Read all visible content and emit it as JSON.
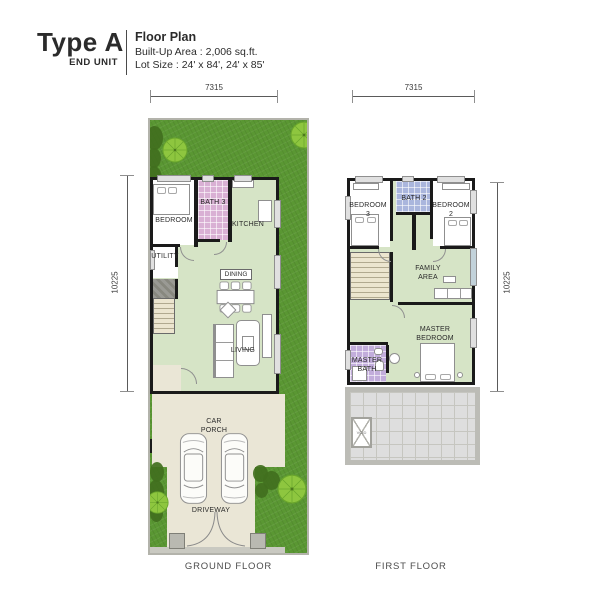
{
  "header": {
    "type": "Type A",
    "unit": "END UNIT",
    "title": "Floor Plan",
    "built_up": "Built-Up Area : 2,006 sq.ft.",
    "lot_size": "Lot Size : 24' x 84', 24' x 85'"
  },
  "ground_floor": {
    "caption": "GROUND FLOOR",
    "dims": {
      "width": "7315",
      "depth": "10225"
    },
    "labels": {
      "bedroom": "BEDROOM",
      "bath": "BATH 3",
      "kitchen": "KITCHEN",
      "utility": "UTILITY",
      "dining": "DINING",
      "living": "LIVING",
      "car_porch_1": "CAR",
      "car_porch_2": "PORCH",
      "driveway": "DRIVEWAY"
    }
  },
  "first_floor": {
    "caption": "FIRST FLOOR",
    "dims": {
      "width": "7315",
      "depth": "10225"
    },
    "labels": {
      "bedroom3_name": "BEDROOM",
      "bedroom3_no": "3",
      "bath2": "BATH 2",
      "bedroom2_name": "BEDROOM",
      "bedroom2_no": "2",
      "family_1": "FAMILY",
      "family_2": "AREA",
      "master_1": "MASTER",
      "master_2": "BEDROOM",
      "master_bath_1": "MASTER",
      "master_bath_2": "BATH",
      "void": "VOID"
    }
  },
  "colors": {
    "grass": "#5a9733",
    "tree": "#8ec63f",
    "floor_green": "#d6e4c6",
    "bath_pink": "#d9b0d4",
    "bath_blue": "#aab6dd",
    "bath_purple": "#c2addb",
    "paving": "#eae6d6",
    "roof_grey": "#dedede",
    "wall": "#1a1a1a"
  }
}
